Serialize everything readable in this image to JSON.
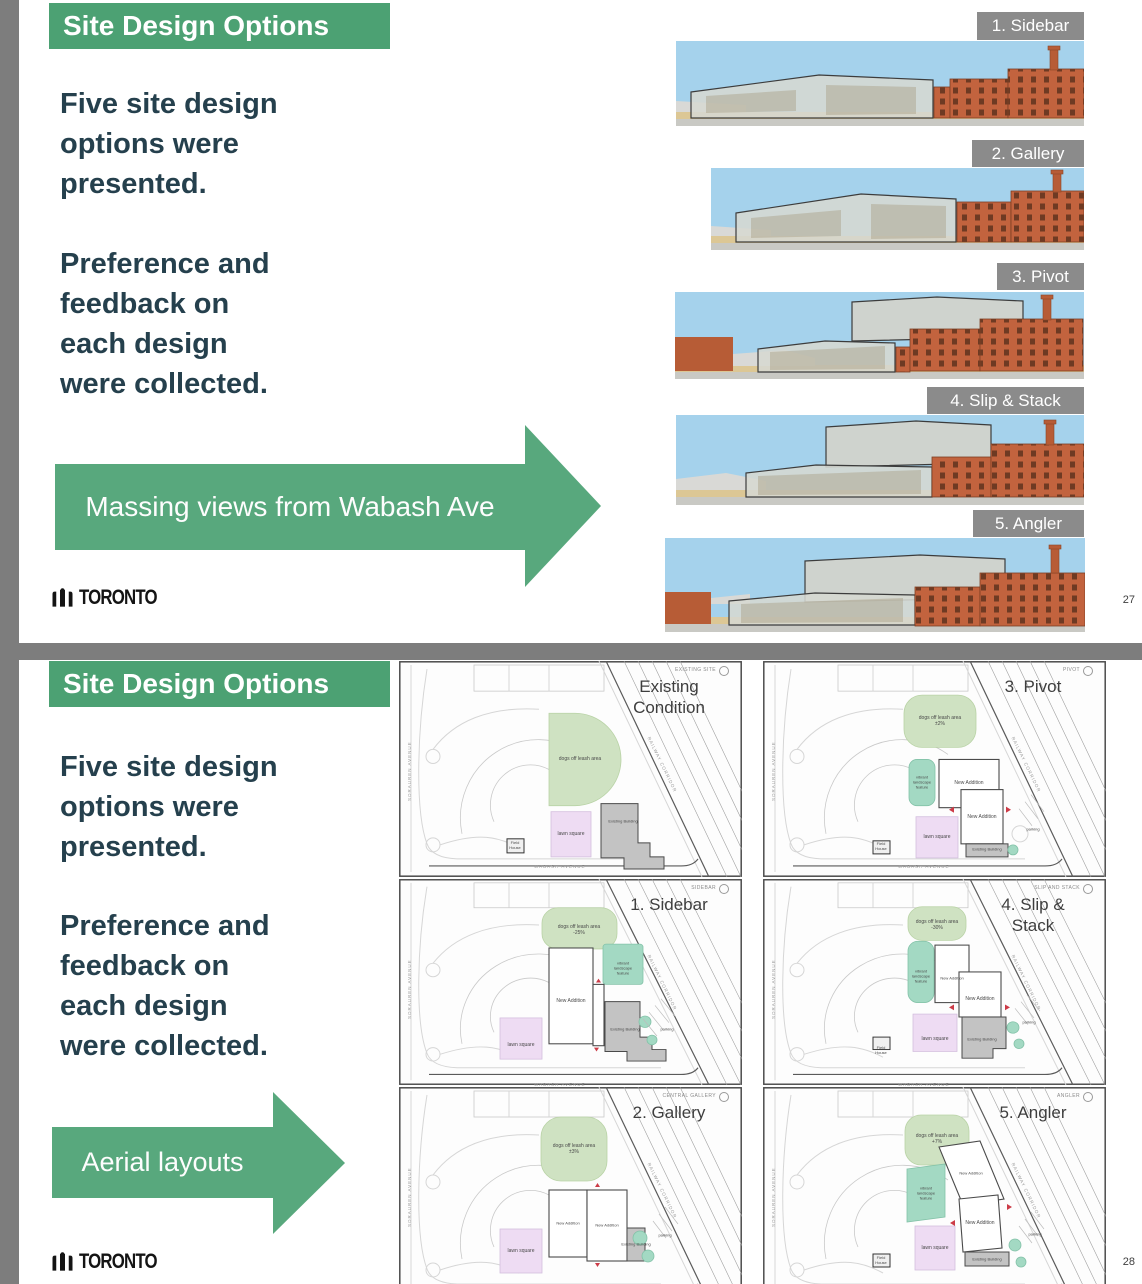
{
  "colors": {
    "accent_green": "#4ca173",
    "arrow_green": "#58a87d",
    "page_bg": "#7d7d7d",
    "slide_bg": "#ffffff",
    "dark_text": "#25404d",
    "label_gray": "#8b8b8b"
  },
  "logo": {
    "text": "TORONTO"
  },
  "slide27": {
    "header": "Site Design Options",
    "para1": "Five site design\noptions were\npresented.",
    "para2": "Preference and\nfeedback on\neach design\nwere collected.",
    "arrow_label": "Massing views from Wabash Ave",
    "page_number": "27",
    "massing_views": [
      {
        "label": "1. Sidebar"
      },
      {
        "label": "2. Gallery"
      },
      {
        "label": "3. Pivot"
      },
      {
        "label": "4. Slip & Stack"
      },
      {
        "label": "5. Angler"
      }
    ]
  },
  "slide28": {
    "header": "Site Design Options",
    "para1": "Five site design\noptions were\npresented.",
    "para2": "Preference and\nfeedback on\neach design\nwere collected.",
    "arrow_label": "Aerial layouts",
    "page_number": "28",
    "plan_labels": {
      "new_addition": "New Addition",
      "existing_building": "Existing Building",
      "lawn_square": "lawn square",
      "field_house": "Field\nHouse",
      "landscape": "vibrant\nlandscape\nfeature",
      "parking": "parking",
      "street_left": "SORAUREN AVENUE",
      "street_bottom": "WABASH AVENUE",
      "street_diag": "RAILWAY CORRIDOR"
    },
    "panels": [
      {
        "title": "Existing\nCondition",
        "tag": "EXISTING SITE",
        "dogs": "dogs off leash area"
      },
      {
        "title": "1. Sidebar",
        "tag": "SIDEBAR",
        "dogs": "dogs off leash area\n-25%"
      },
      {
        "title": "2. Gallery",
        "tag": "CENTRAL GALLERY",
        "dogs": "dogs off leash area\n±3%"
      },
      {
        "title": "3. Pivot",
        "tag": "PIVOT",
        "dogs": "dogs off leash area\n±2%"
      },
      {
        "title": "4. Slip &\nStack",
        "tag": "SLIP AND STACK",
        "dogs": "dogs off leash area\n-30%"
      },
      {
        "title": "5. Angler",
        "tag": "ANGLER",
        "dogs": "dogs off leash area\n+7%"
      }
    ]
  }
}
